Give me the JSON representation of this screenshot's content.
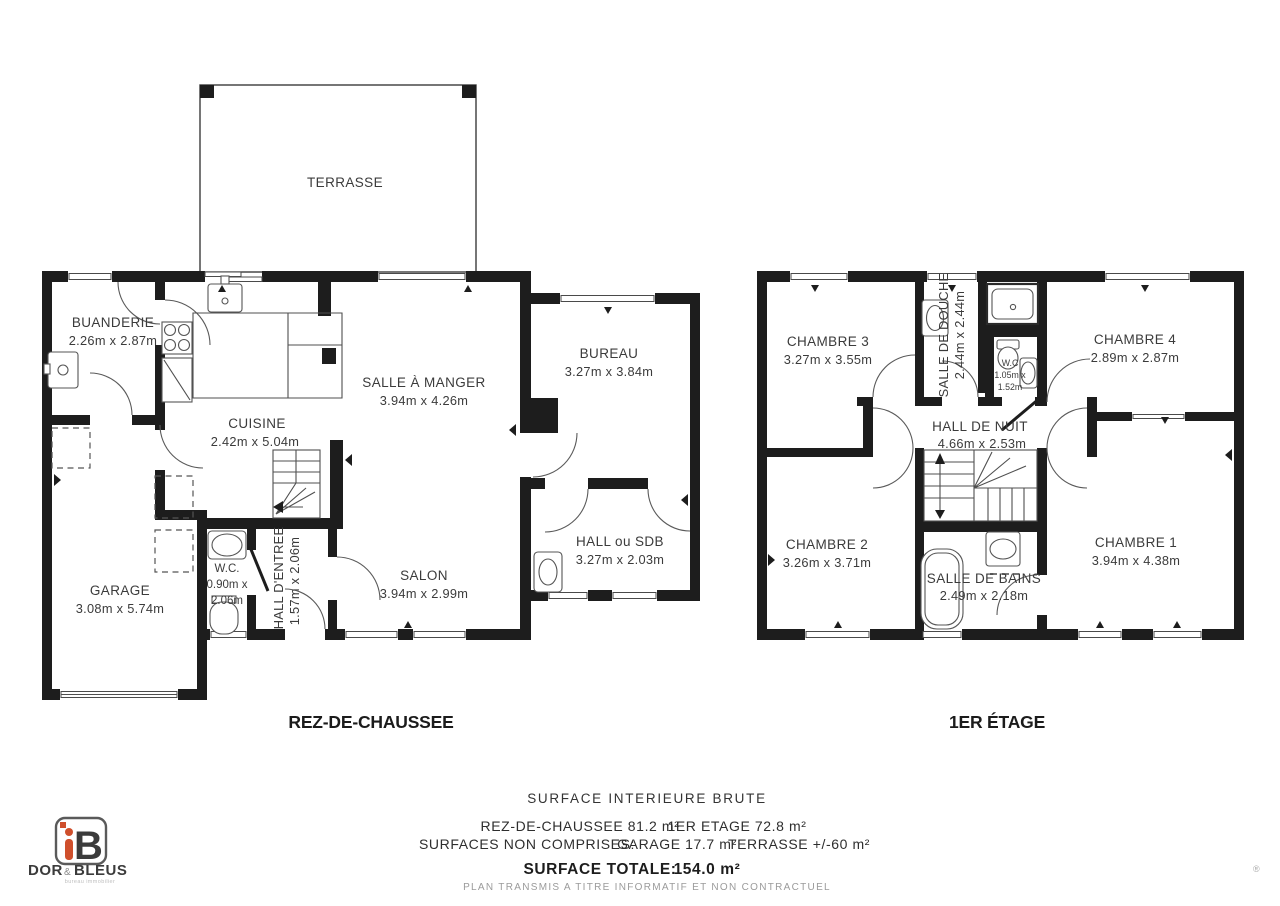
{
  "ground_floor": {
    "title": "REZ-DE-CHAUSSEE",
    "terrasse": {
      "name": "TERRASSE"
    },
    "buanderie": {
      "name": "BUANDERIE",
      "dims": "2.26m x 2.87m"
    },
    "cuisine": {
      "name": "CUISINE",
      "dims": "2.42m x 5.04m"
    },
    "salle_a_manger": {
      "name": "SALLE À MANGER",
      "dims": "3.94m x 4.26m"
    },
    "bureau": {
      "name": "BUREAU",
      "dims": "3.27m x 3.84m"
    },
    "hall_ou_sdb": {
      "name": "HALL ou SDB",
      "dims": "3.27m x 2.03m"
    },
    "salon": {
      "name": "SALON",
      "dims": "3.94m x 2.99m"
    },
    "wc": {
      "name": "W.C.",
      "dims_line1": "0.90m x",
      "dims_line2": "2.06m"
    },
    "hall_entree": {
      "name": "HALL D'ENTREE",
      "dims": "1.57m x 2.06m"
    },
    "garage": {
      "name": "GARAGE",
      "dims": "3.08m x 5.74m"
    }
  },
  "first_floor": {
    "title": "1ER ÉTAGE",
    "chambre3": {
      "name": "CHAMBRE 3",
      "dims": "3.27m x 3.55m"
    },
    "salle_de_douche": {
      "name": "SALLE DE DOUCHE",
      "dims": "2.44m x 2.44m"
    },
    "wc": {
      "name": "W.C",
      "dims_line1": "1.05m x",
      "dims_line2": "1.52m"
    },
    "chambre4": {
      "name": "CHAMBRE 4",
      "dims": "2.89m x 2.87m"
    },
    "hall_de_nuit": {
      "name": "HALL DE NUIT",
      "dims": "4.66m x 2.53m"
    },
    "chambre2": {
      "name": "CHAMBRE 2",
      "dims": "3.26m x 3.71m"
    },
    "salle_de_bains": {
      "name": "SALLE DE BAINS",
      "dims": "2.49m x 2.18m"
    },
    "chambre1": {
      "name": "CHAMBRE 1",
      "dims": "3.94m x 4.38m"
    }
  },
  "summary": {
    "title": "SURFACE INTERIEURE BRUTE",
    "line1a": "REZ-DE-CHAUSSEE 81.2 m²",
    "line1b": "1ER ETAGE 72.8 m²",
    "line2a": "SURFACES NON COMPRISES:",
    "line2b": "GARAGE 17.7 m²",
    "line2c": "TERRASSE +/-60 m²",
    "total_label": "SURFACE TOTALE:",
    "total_value": "154.0 m²",
    "disclaimer": "PLAN TRANSMIS A TITRE INFORMATIF ET NON CONTRACTUEL"
  },
  "logo": {
    "letter_i": "i",
    "letter_b": "B",
    "word1": "DOR",
    "amp": "&",
    "word2": "BLEUS",
    "tagline": "bureau immobilier",
    "accent": "#cf4f2c",
    "dark": "#4b4b52"
  },
  "marks": {
    "registered": "®"
  }
}
